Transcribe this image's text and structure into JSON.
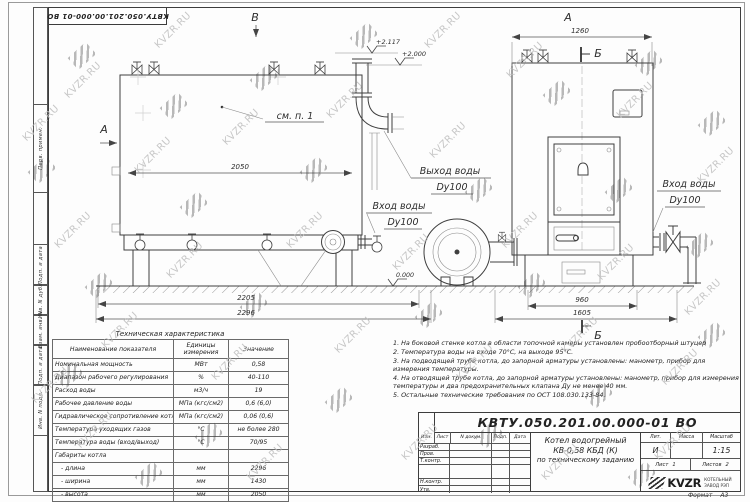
{
  "watermark": {
    "text": "KVZR.RU"
  },
  "stamp_box": {
    "doc_number": "КВТУ.050.201.00.000-01 ВО"
  },
  "sidebar": {
    "cells": [
      "Перв. примен.",
      "Подп. и дата",
      "Инв. N дубл.",
      "Взам. инв. N",
      "Подп. и дата",
      "Инв. N подл."
    ]
  },
  "drawing": {
    "view_a": "А",
    "view_b": "В",
    "section_b": "Б",
    "see_note": "см. п. 1",
    "elev_top": "+2.117",
    "elev_mid": "+2.000",
    "elev_zero": "0.000",
    "dim_2050": "2050",
    "dim_2205": "2205",
    "dim_2296": "2296",
    "dim_1260": "1260",
    "dim_960": "960",
    "dim_1605": "1605",
    "outlet_line1": "Выход воды",
    "outlet_line2": "Dy100",
    "inlet_line1": "Вход воды",
    "inlet_line2": "Dy100"
  },
  "table": {
    "title": "Техническая характеристика",
    "headers": [
      "Наименование показателя",
      "Единицы измерения",
      "Значение"
    ],
    "rows": [
      [
        "Номинальная мощность",
        "МВт",
        "0,58"
      ],
      [
        "Диапазон рабочего регулирования",
        "%",
        "40-110"
      ],
      [
        "Расход воды",
        "м3/ч",
        "19"
      ],
      [
        "Рабочее давление воды",
        "МПа (кгс/см2)",
        "0,6 (6,0)"
      ],
      [
        "Гидравлическое сопротивление котла",
        "МПа (кгс/см2)",
        "0,06 (0,6)"
      ],
      [
        "Температура уходящих газов",
        "°С",
        "не более 280"
      ],
      [
        "Температура воды (вход/выход)",
        "°С",
        "70/95"
      ],
      [
        "Габариты котла",
        "",
        ""
      ],
      [
        "- длина",
        "мм",
        "2296"
      ],
      [
        "- ширина",
        "мм",
        "1430"
      ],
      [
        "- высота",
        "мм",
        "2050"
      ]
    ]
  },
  "notes": [
    "1. На боковой стенке котла в области топочной камеры установлен пробоотборный штуцер",
    "2. Температура воды на входе 70°С, на выходе 95°С.",
    "3. На подводящей трубе котла, до запорной арматуры установлены: манометр, прибор для измерения температуры.",
    "4. На отводящей трубе котла, до запорной арматуры установлены: манометр, прибор для измерения температуры и два предохранительных клапана Ду не менее 40 мм.",
    "5. Остальные технические требования по ОСТ 108.030.133-84."
  ],
  "titleblock": {
    "doc_number": "КВТУ.050.201.00.000-01 ВО",
    "rev_headers": [
      "Изм.",
      "Лист",
      "N докум.",
      "Подп.",
      "Дата"
    ],
    "roles": [
      "Разраб.",
      "Пров.",
      "Т.контр.",
      "",
      "Н.контр.",
      "Утв."
    ],
    "title_line1": "Котел водогрейный",
    "title_line2": "КВ-0,58 КБД (К)",
    "title_line3": "по техническому заданию",
    "lit_header": "Лит.",
    "mass_header": "Масса",
    "scale_header": "Масштаб",
    "lit_value": "И",
    "mass_value": "",
    "scale_value": "1:15",
    "sheet_label": "Лист",
    "sheet_value": "1",
    "sheets_label": "Листов",
    "sheets_value": "2",
    "brand": "KVZR",
    "company_line1": "КОТЕЛЬНЫЙ",
    "company_line2": "ЗАВОД РЭП",
    "format_label": "Формат",
    "format_value": "А3"
  }
}
